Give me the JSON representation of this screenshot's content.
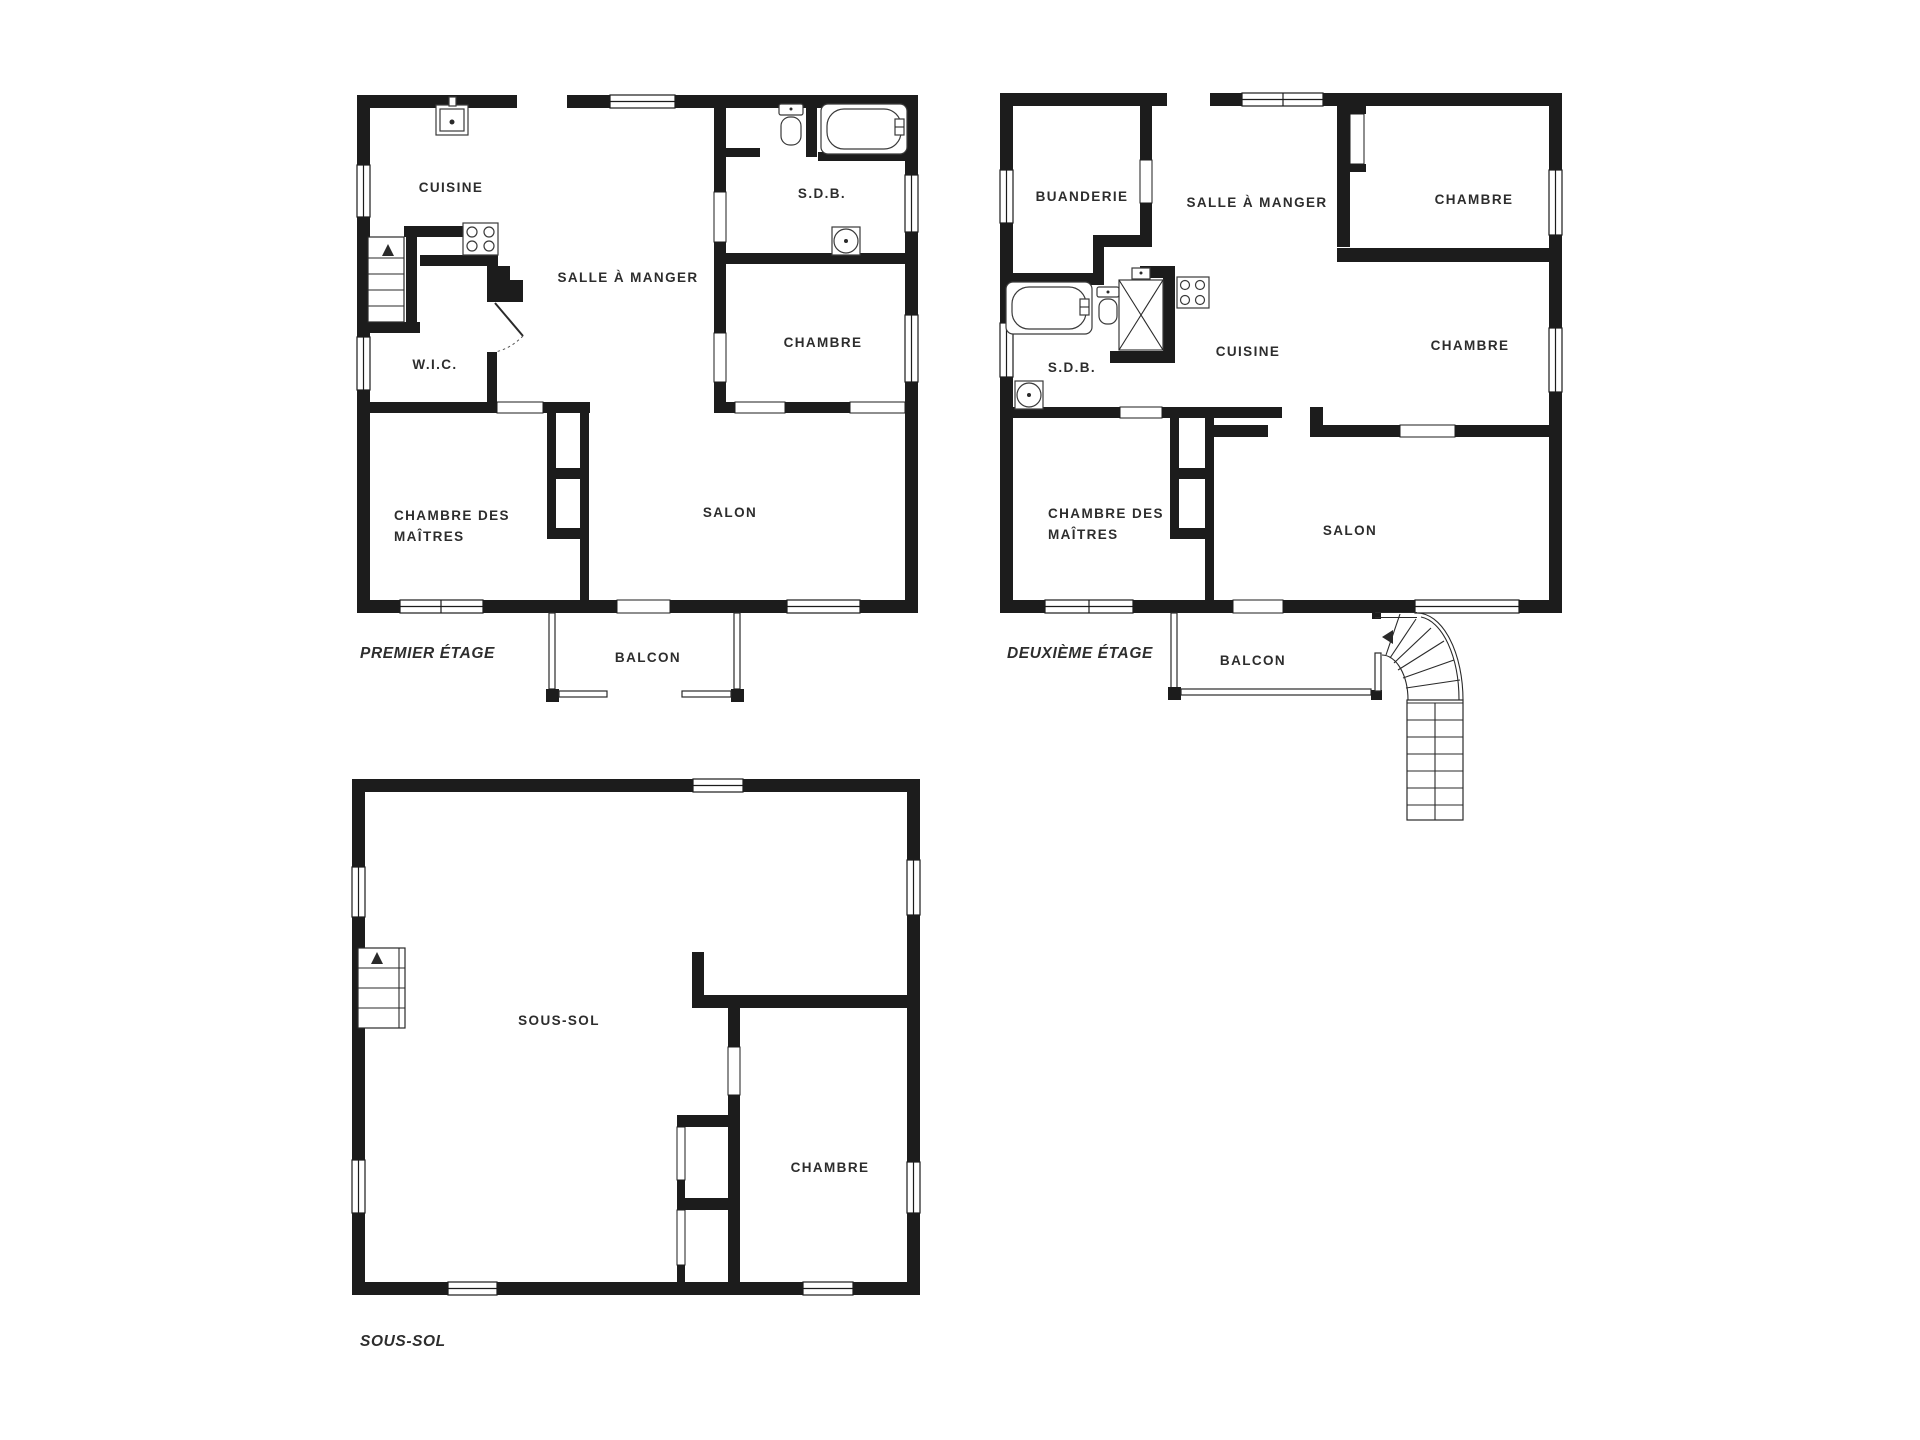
{
  "theme": {
    "wall_color": "#1c1c1c",
    "label_color": "#2d2d2d",
    "background": "#ffffff"
  },
  "floors": {
    "premier": {
      "title": "PREMIER ÉTAGE",
      "rooms": {
        "cuisine": "CUISINE",
        "salle_a_manger": "SALLE À MANGER",
        "sdb": "S.D.B.",
        "chambre": "CHAMBRE",
        "wic": "W.I.C.",
        "chambre_des_maitres_line1": "CHAMBRE DES",
        "chambre_des_maitres_line2": "MAÎTRES",
        "salon": "SALON",
        "balcon": "BALCON"
      }
    },
    "deuxieme": {
      "title": "DEUXIÈME ÉTAGE",
      "rooms": {
        "buanderie": "BUANDERIE",
        "salle_a_manger": "SALLE À MANGER",
        "chambre_haut": "CHAMBRE",
        "sdb": "S.D.B.",
        "cuisine": "CUISINE",
        "chambre_bas": "CHAMBRE",
        "chambre_des_maitres_line1": "CHAMBRE DES",
        "chambre_des_maitres_line2": "MAÎTRES",
        "salon": "SALON",
        "balcon": "BALCON"
      }
    },
    "sous_sol": {
      "title": "SOUS-SOL",
      "rooms": {
        "sous_sol": "SOUS-SOL",
        "chambre": "CHAMBRE"
      }
    }
  },
  "icons": {
    "kitchen_sink": "kitchen-sink-icon",
    "stove": "stove-icon",
    "toilet": "toilet-icon",
    "bathtub": "bathtub-icon",
    "shower": "shower-icon",
    "round_fixture": "round-fixture-icon",
    "stairs_up": "stairs-up-icon",
    "curved_staircase": "curved-staircase-icon",
    "direction_arrow": "direction-arrow-icon"
  }
}
